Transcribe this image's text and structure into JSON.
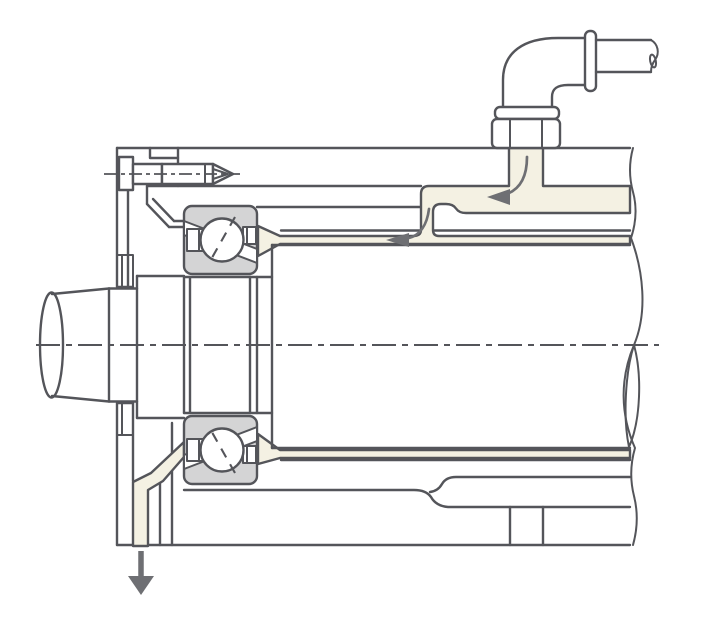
{
  "diagram": {
    "colors": {
      "background": "#ffffff",
      "line": "#54555a",
      "arrow": "#6e6f73",
      "bearingFill": "#d4d4d5",
      "channelFill": "#f4f1e3",
      "white": "#ffffff"
    },
    "icons": {
      "inlet_flow_arrow": "curved-arrow-left",
      "channel_flow_arrow": "curved-arrow-left",
      "drain_arrow": "arrow-down"
    }
  }
}
